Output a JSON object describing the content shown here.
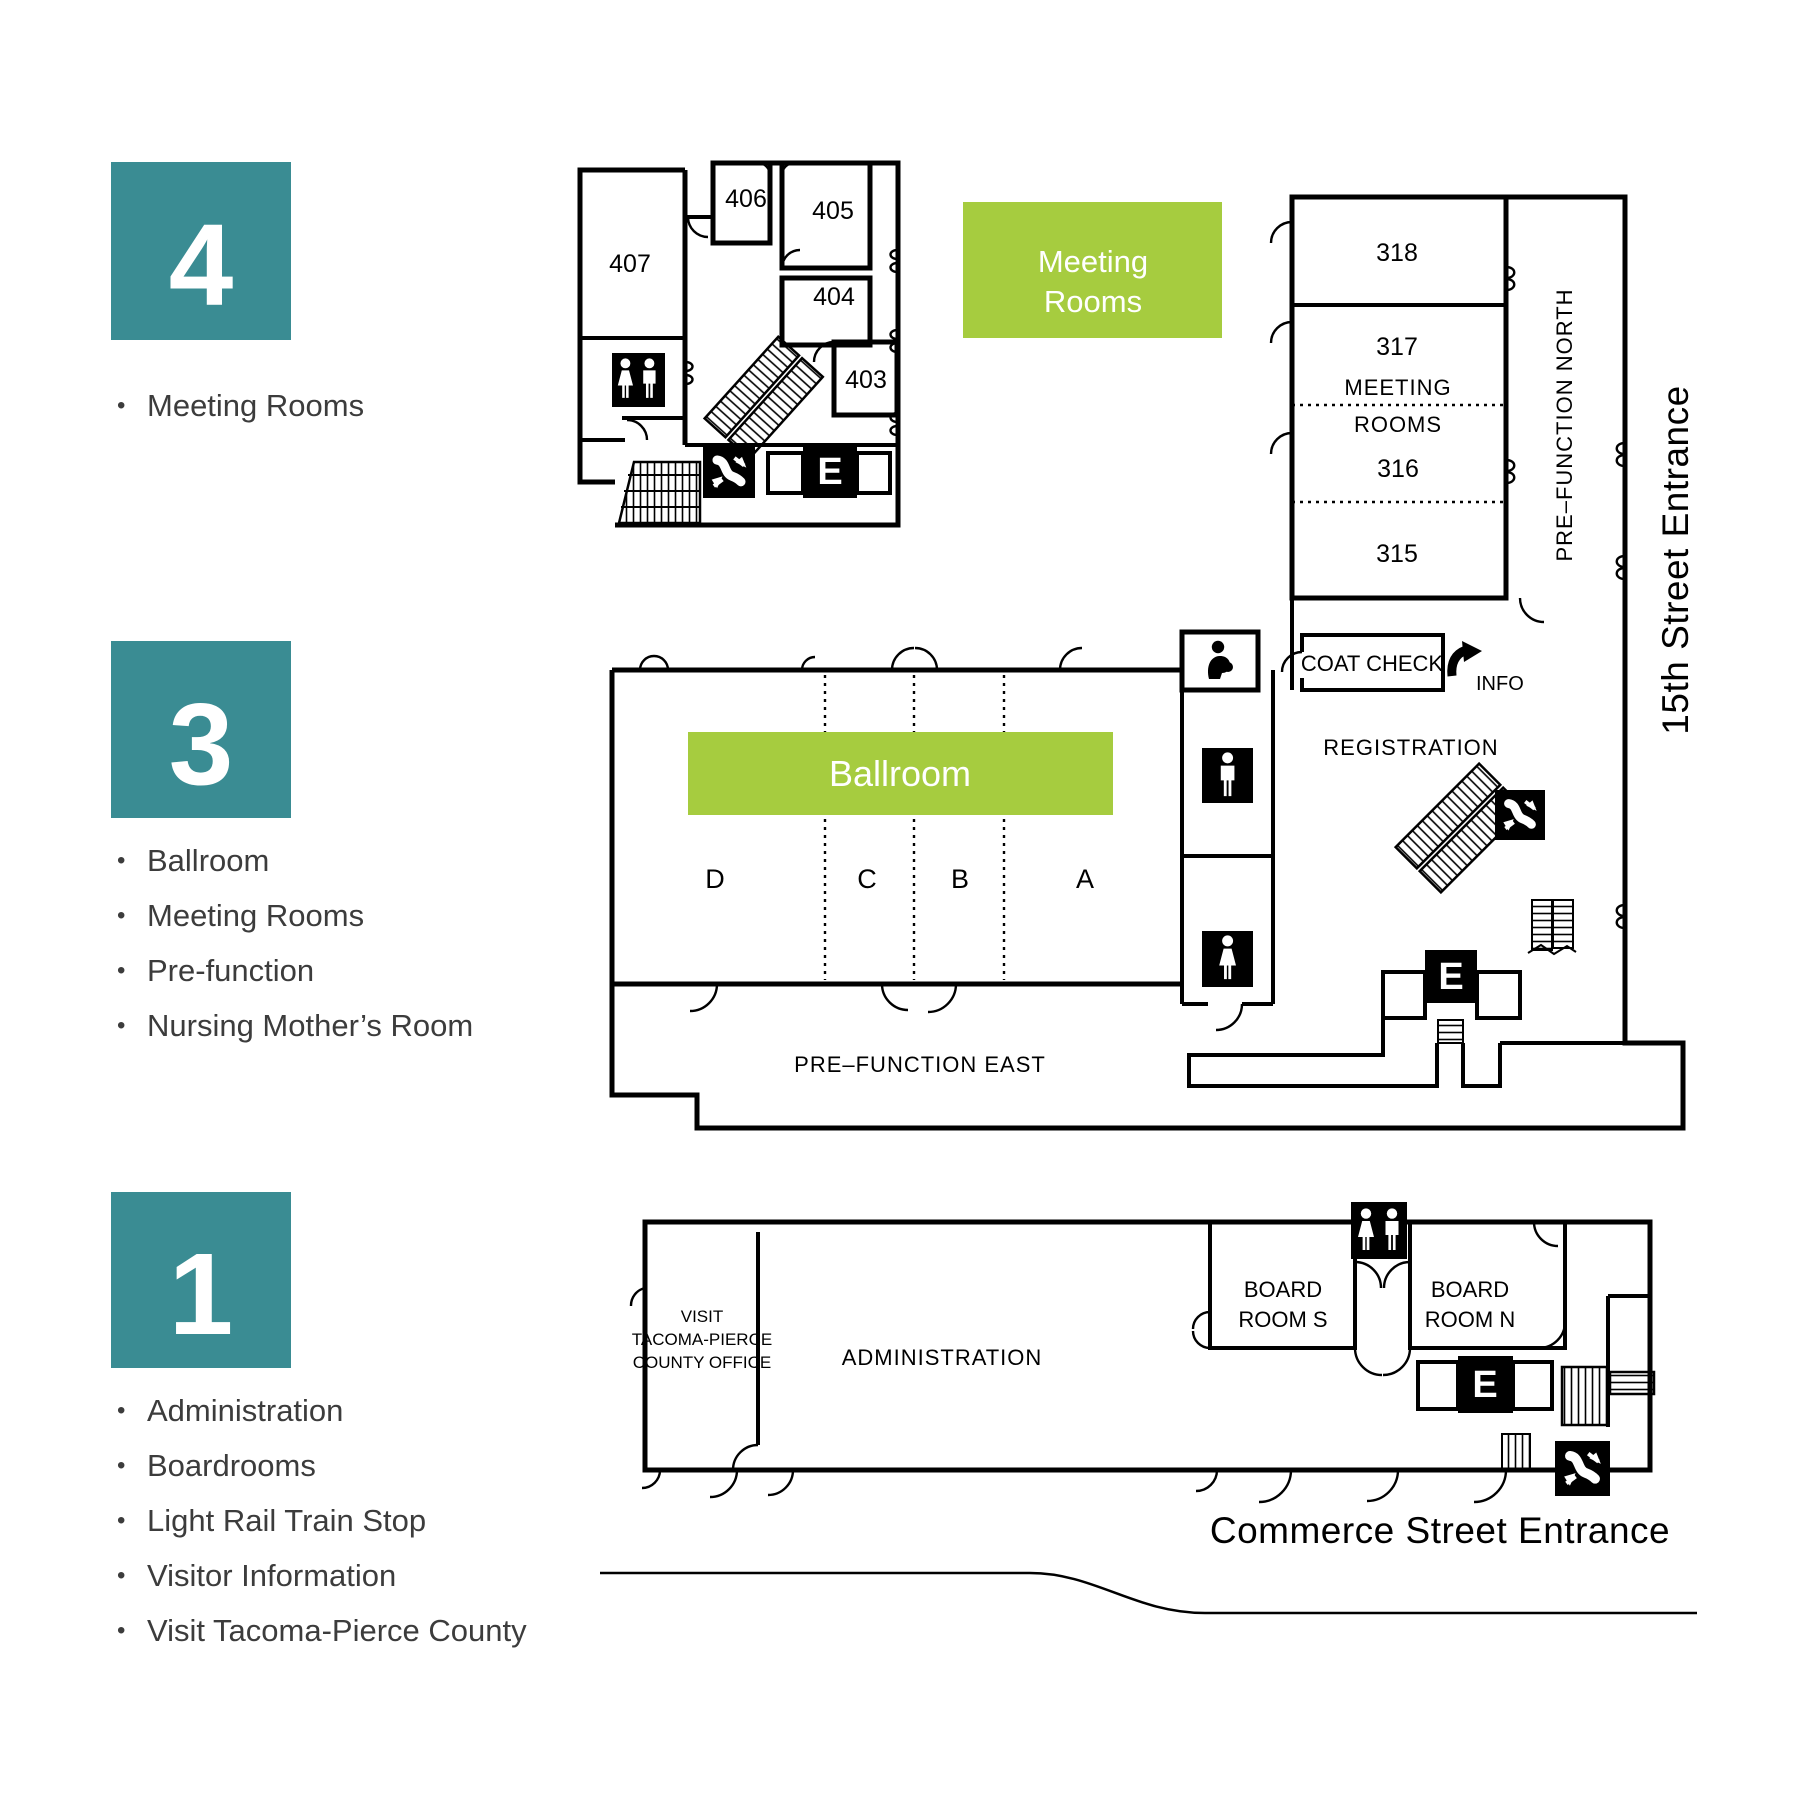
{
  "colors": {
    "teal": "#3a8c93",
    "green": "#a6cc3f",
    "ink": "#000000",
    "text": "#3c3c3c"
  },
  "legend": {
    "floors": [
      {
        "number": "4",
        "items": [
          "Meeting Rooms"
        ]
      },
      {
        "number": "3",
        "items": [
          "Ballroom",
          "Meeting Rooms",
          "Pre-function",
          "Nursing Mother’s Room"
        ]
      },
      {
        "number": "1",
        "items": [
          "Administration",
          "Boardrooms",
          "Light Rail Train Stop",
          "Visitor Information",
          "Visit Tacoma-Pierce County"
        ]
      }
    ]
  },
  "floor4": {
    "green_label": [
      "Meeting",
      "Rooms"
    ],
    "rooms": {
      "r407": "407",
      "r406": "406",
      "r405": "405",
      "r404": "404",
      "r403": "403"
    },
    "elevator": "E"
  },
  "floor3": {
    "rooms": {
      "r318": "318",
      "r317": "317",
      "r316": "316",
      "r315": "315"
    },
    "meeting_rooms_label": [
      "MEETING",
      "ROOMS"
    ],
    "coat_check": "COAT CHECK",
    "info": "INFO",
    "registration": "REGISTRATION",
    "prefunction_north": "PRE–FUNCTION NORTH",
    "prefunction_east": "PRE–FUNCTION EAST",
    "street_entrance": "15th Street Entrance",
    "ballroom": "Ballroom",
    "sections": [
      "D",
      "C",
      "B",
      "A"
    ],
    "elevator": "E"
  },
  "floor1": {
    "visit_office": [
      "VISIT",
      "TACOMA-PIERCE",
      "COUNTY OFFICE"
    ],
    "administration": "ADMINISTRATION",
    "board_room_s": [
      "BOARD",
      "ROOM S"
    ],
    "board_room_n": [
      "BOARD",
      "ROOM N"
    ],
    "street_entrance": "Commerce Street Entrance",
    "elevator": "E"
  }
}
